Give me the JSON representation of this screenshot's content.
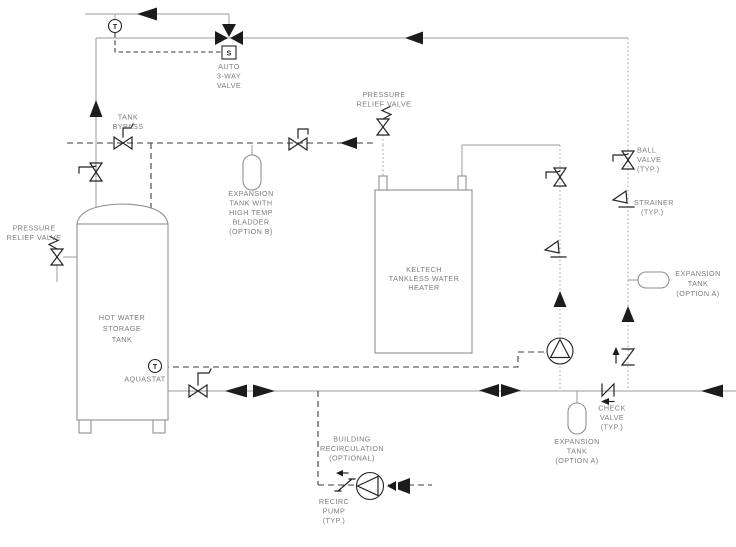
{
  "colors": {
    "background": "#ffffff",
    "pipe_line": "#9b9b9b",
    "control_dash_line": "#3c3c3c",
    "symbol": "#1c1c1c",
    "label_text": "#7c7c7c"
  },
  "labels": {
    "thermometer_top": "T",
    "aquastat_sensor": "T",
    "solenoid_actuator": "S",
    "auto_3way_valve": [
      "AUTO",
      "3-WAY",
      "VALVE"
    ],
    "pressure_relief_valve_top": [
      "PRESSURE",
      "RELIEF VALVE"
    ],
    "tank_bypass": [
      "TANK",
      "BYPASS"
    ],
    "expansion_tank_option_b": [
      "EXPANSION",
      "TANK WITH",
      "HIGH TEMP",
      "BLADDER",
      "(OPTION B)"
    ],
    "pressure_relief_valve_left": [
      "PRESSURE",
      "RELIEF VALVE"
    ],
    "storage_tank": [
      "HOT WATER",
      "STORAGE",
      "TANK"
    ],
    "heater": [
      "KELTECH",
      "TANKLESS WATER",
      "HEATER"
    ],
    "ball_valve": [
      "BALL",
      "VALVE",
      "(TYP.)"
    ],
    "strainer": [
      "STRAINER",
      "(TYP.)"
    ],
    "expansion_tank_right": [
      "EXPANSION",
      "TANK",
      "(OPTION A)"
    ],
    "check_valve": [
      "CHECK",
      "VALVE",
      "(TYP.)"
    ],
    "expansion_tank_bottom": [
      "EXPANSION",
      "TANK",
      "(OPTION A)"
    ],
    "aquastat": "AQUASTAT",
    "building_recirculation": [
      "BUILDING",
      "RECIRCULATION",
      "(OPTIONAL)"
    ],
    "recirc_pump": [
      "RECIRC",
      "PUMP",
      "(TYP.)"
    ]
  }
}
